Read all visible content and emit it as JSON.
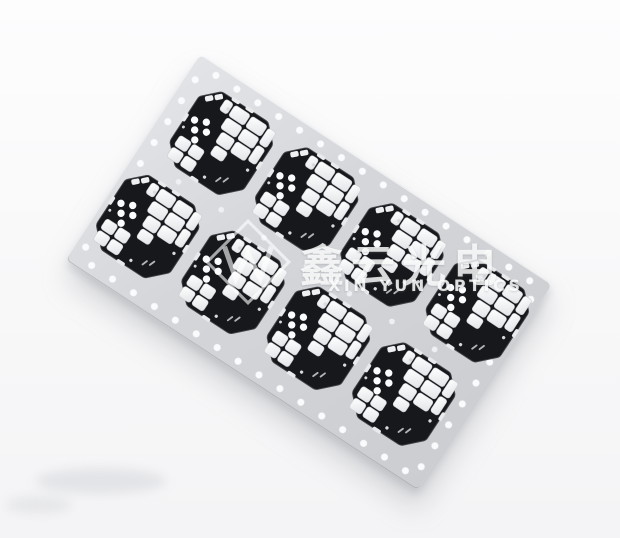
{
  "image": {
    "subject": "Panel array of 8 black aluminum LED PCB modules on a gray carrier strip with sprocket holes",
    "background_color": "#f7f7f8"
  },
  "panel": {
    "color": "#d3d5d9",
    "rotation_deg": 33.2,
    "grid": {
      "columns": 4,
      "rows": 2
    },
    "module_count": 8,
    "sprocket_hole_color": "#fafbfc"
  },
  "module": {
    "base_color": "#17181b",
    "pad_color": "#f4f5f7",
    "dice_dot_count": 5
  },
  "watermark": {
    "logo": "diamond-w-monogram",
    "cjk_text": "鑫云光电",
    "latin_text": "XIN YUN OPTICS",
    "color_rgba": "rgba(255,255,255,0.8)"
  }
}
